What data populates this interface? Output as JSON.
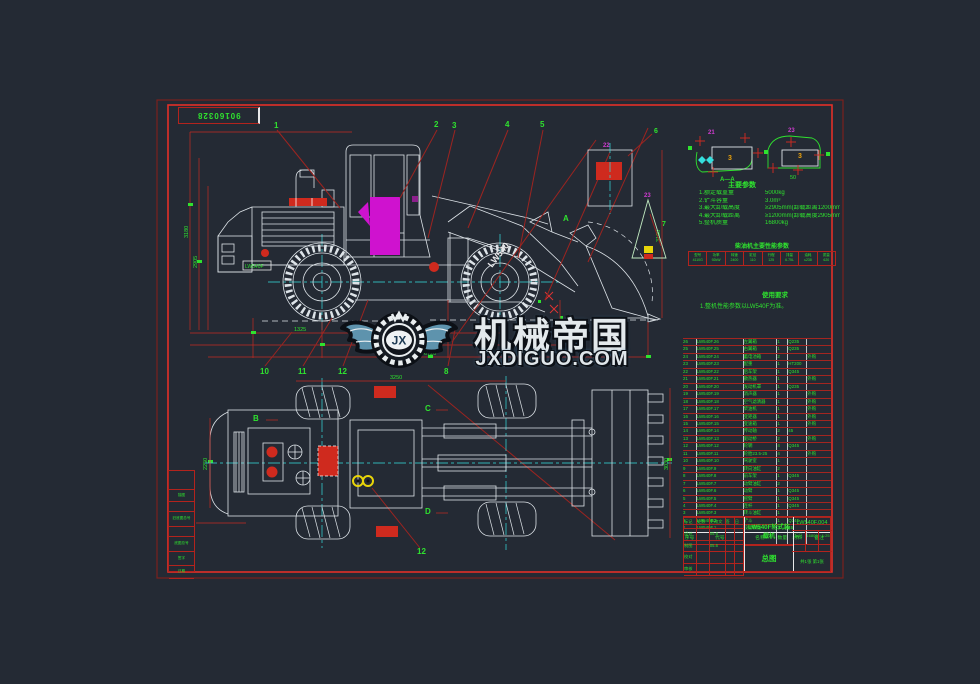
{
  "sheet": {
    "number": "90160328"
  },
  "watermark": {
    "title": "机械帝国",
    "subtitle": "JXDIGUO.COM",
    "monogram": "JX"
  },
  "labels": {
    "b1": "1",
    "b2": "2",
    "b3": "3",
    "b4": "4",
    "b5": "5",
    "b8": "8",
    "b10": "10",
    "b11": "11",
    "b12": "12",
    "b12b": "12",
    "secA": "A",
    "secB": "B",
    "secC": "C",
    "secD": "D",
    "d6": "6",
    "d7": "7",
    "d21": "21",
    "d22": "22",
    "d23": "23",
    "d3a": "3",
    "d3b": "3",
    "dAA": "A—A",
    "boom_decal": "LW540",
    "hood_decal": "LW540F"
  },
  "dims": {
    "h1": "3180",
    "h2": "2905",
    "h3": "3100",
    "len1": "1325",
    "len2": "2760",
    "len3": "6720",
    "wheelbase": "3250",
    "track": "2250",
    "bucket_w": "3030",
    "d50": "50"
  },
  "params": {
    "title": "主要参数",
    "items": [
      {
        "label": "1.额定载重量",
        "value": "5000kg"
      },
      {
        "label": "2.铲斗容量",
        "value": "3.0m³"
      },
      {
        "label": "3.最大卸载高度",
        "value": "≥2905mm(卸载距离1200mm)"
      },
      {
        "label": "4.最大卸载距离",
        "value": "≥1200mm(卸载高度2905mm)"
      },
      {
        "label": "5.整机质量",
        "value": "16800kg"
      }
    ]
  },
  "engine_table": {
    "title": "柴油机主要性能参数",
    "cells": [
      [
        "型号",
        "4110G"
      ],
      [
        "功率",
        "92kW"
      ],
      [
        "转速",
        "2400"
      ],
      [
        "缸径",
        "110"
      ],
      [
        "行程",
        "125"
      ],
      [
        "排量",
        "6.75L"
      ],
      [
        "油耗",
        "≤238"
      ],
      [
        "质量",
        "620"
      ]
    ]
  },
  "notes": {
    "title": "使用要求",
    "line1": "1.整机性能参数以LW540F为准。"
  },
  "bom": {
    "headers": [
      "序号",
      "代号",
      "名称",
      "数量",
      "材料",
      "备注"
    ],
    "rows": [
      {
        "no": "26",
        "code": "LW540F.26",
        "name": "左翼箱",
        "qty": "1",
        "mat": "Q235",
        "note": ""
      },
      {
        "no": "25",
        "code": "LW540F.25",
        "name": "右翼箱",
        "qty": "1",
        "mat": "Q235",
        "note": ""
      },
      {
        "no": "24",
        "code": "LW540F.24",
        "name": "蓄电池箱",
        "qty": "2",
        "mat": "",
        "note": "外购"
      },
      {
        "no": "23",
        "code": "LW540F.23",
        "name": "配重",
        "qty": "1",
        "mat": "HT200",
        "note": ""
      },
      {
        "no": "22",
        "code": "LW540F.22",
        "name": "后车架",
        "qty": "1",
        "mat": "Q345",
        "note": ""
      },
      {
        "no": "21",
        "code": "LW540F.21",
        "name": "散热器",
        "qty": "1",
        "mat": "",
        "note": "外购"
      },
      {
        "no": "20",
        "code": "LW540F.20",
        "name": "发动机罩",
        "qty": "1",
        "mat": "Q235",
        "note": ""
      },
      {
        "no": "19",
        "code": "LW540F.19",
        "name": "消声器",
        "qty": "1",
        "mat": "",
        "note": "外购"
      },
      {
        "no": "18",
        "code": "LW540F.18",
        "name": "空气滤清器",
        "qty": "1",
        "mat": "",
        "note": "外购"
      },
      {
        "no": "17",
        "code": "LW540F.17",
        "name": "柴油机",
        "qty": "1",
        "mat": "",
        "note": "外购"
      },
      {
        "no": "16",
        "code": "LW540F.16",
        "name": "变矩器",
        "qty": "1",
        "mat": "",
        "note": "外购"
      },
      {
        "no": "15",
        "code": "LW540F.15",
        "name": "变速箱",
        "qty": "1",
        "mat": "",
        "note": "外购"
      },
      {
        "no": "14",
        "code": "LW540F.14",
        "name": "传动轴",
        "qty": "2",
        "mat": "45",
        "note": ""
      },
      {
        "no": "13",
        "code": "LW540F.13",
        "name": "驱动桥",
        "qty": "2",
        "mat": "",
        "note": "外购"
      },
      {
        "no": "12",
        "code": "LW540F.12",
        "name": "轮辋",
        "qty": "4",
        "mat": "Q345",
        "note": ""
      },
      {
        "no": "11",
        "code": "LW540F.11",
        "name": "轮胎23.5-25",
        "qty": "4",
        "mat": "",
        "note": "外购"
      },
      {
        "no": "10",
        "code": "LW540F.10",
        "name": "驾驶室",
        "qty": "1",
        "mat": "",
        "note": ""
      },
      {
        "no": "9",
        "code": "LW540F.9",
        "name": "转向油缸",
        "qty": "2",
        "mat": "",
        "note": ""
      },
      {
        "no": "8",
        "code": "LW540F.8",
        "name": "前车架",
        "qty": "1",
        "mat": "Q345",
        "note": ""
      },
      {
        "no": "7",
        "code": "LW540F.7",
        "name": "动臂油缸",
        "qty": "2",
        "mat": "",
        "note": ""
      },
      {
        "no": "6",
        "code": "LW540F.6",
        "name": "动臂",
        "qty": "1",
        "mat": "Q345",
        "note": ""
      },
      {
        "no": "5",
        "code": "LW540F.5",
        "name": "摇臂",
        "qty": "1",
        "mat": "Q345",
        "note": ""
      },
      {
        "no": "4",
        "code": "LW540F.4",
        "name": "连杆",
        "qty": "1",
        "mat": "Q345",
        "note": ""
      },
      {
        "no": "3",
        "code": "LW540F.3",
        "name": "转斗油缸",
        "qty": "1",
        "mat": "",
        "note": ""
      },
      {
        "no": "2",
        "code": "LW540F.2",
        "name": "铲斗",
        "qty": "1",
        "mat": "Q345",
        "note": ""
      },
      {
        "no": "1",
        "code": "LW540F.1",
        "name": "铰接销组",
        "qty": "2",
        "mat": "45",
        "note": ""
      }
    ]
  },
  "titleblock": {
    "product": "LW540F轮式装载机",
    "drawing_no": "LW540F.004",
    "view_name": "总图",
    "scale_label": "比例",
    "scale": "1:25",
    "weight_label": "重量",
    "weight": "16800",
    "mark_label": "标记",
    "sheets": "共1张 第1张",
    "sign_rows": [
      [
        "标记",
        "处数",
        "更改文件号",
        "签字",
        "日期"
      ],
      [
        "设计",
        "",
        "05.6",
        "",
        ""
      ],
      [
        "制图",
        "",
        "05.6",
        "",
        ""
      ],
      [
        "校对",
        "",
        "",
        "",
        ""
      ],
      [
        "审核",
        "",
        "",
        "",
        ""
      ]
    ]
  },
  "margin_strip": {
    "cells": [
      "",
      "描图",
      "",
      "旧底图总号",
      "",
      "底图总号",
      "签字",
      "日期"
    ]
  }
}
